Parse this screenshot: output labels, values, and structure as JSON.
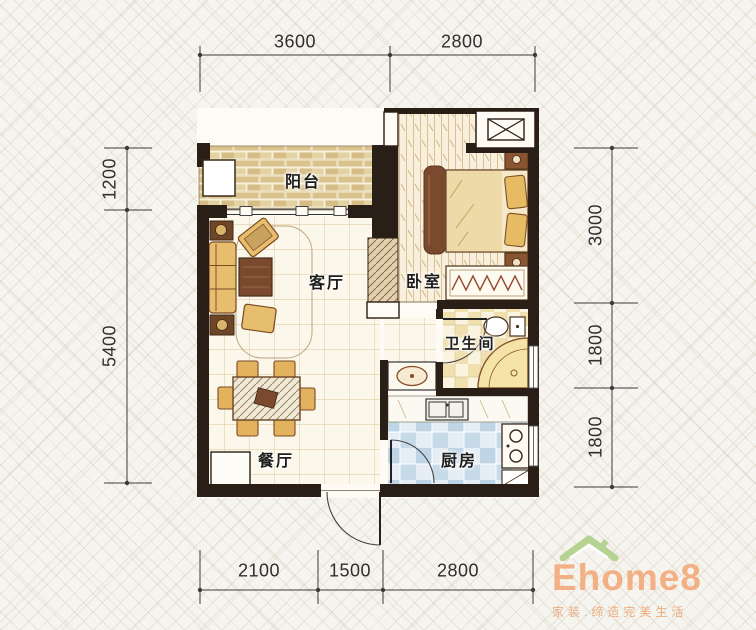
{
  "page": {
    "type": "apartment-floor-plan"
  },
  "floor_plan": {
    "rooms": [
      {
        "id": "balcony",
        "label": "阳台"
      },
      {
        "id": "living-room",
        "label": "客厅"
      },
      {
        "id": "bedroom",
        "label": "卧室"
      },
      {
        "id": "bathroom",
        "label": "卫生间"
      },
      {
        "id": "dining-room",
        "label": "餐厅"
      },
      {
        "id": "kitchen",
        "label": "厨房"
      }
    ],
    "dimensions_mm": {
      "top": [
        "3600",
        "2800"
      ],
      "left": [
        "1200",
        "5400"
      ],
      "right": [
        "3000",
        "1800",
        "1800"
      ],
      "bottom": [
        "2100",
        "1500",
        "2800"
      ]
    },
    "fixtures": [
      "sofa",
      "armchairs",
      "coffee-table",
      "side-tables",
      "rug",
      "dining-table",
      "dining-chairs",
      "entry-cabinet",
      "double-bed",
      "nightstands",
      "wardrobe",
      "bedside-rug",
      "air-conditioner-platform",
      "toilet",
      "corner-bathtub",
      "washbasin",
      "kitchen-counter",
      "kitchen-sink",
      "stove"
    ]
  },
  "branding": {
    "logo_text": "Ehome8",
    "tagline": "家装.缔造完美生活",
    "logo_color": "#f2b084",
    "roof_color": "#b5d393"
  },
  "palette": {
    "wall": "#2a1f16",
    "dimension_line": "#3b3b3b",
    "brick": "#e0cd9c",
    "wood_floor": "#f8f0dc",
    "bath_tile": "#f0e0ad",
    "kitchen_tile": "#bfd4e4",
    "furniture_tan": "#e7bd6e",
    "furniture_brown": "#7b4a2e"
  }
}
